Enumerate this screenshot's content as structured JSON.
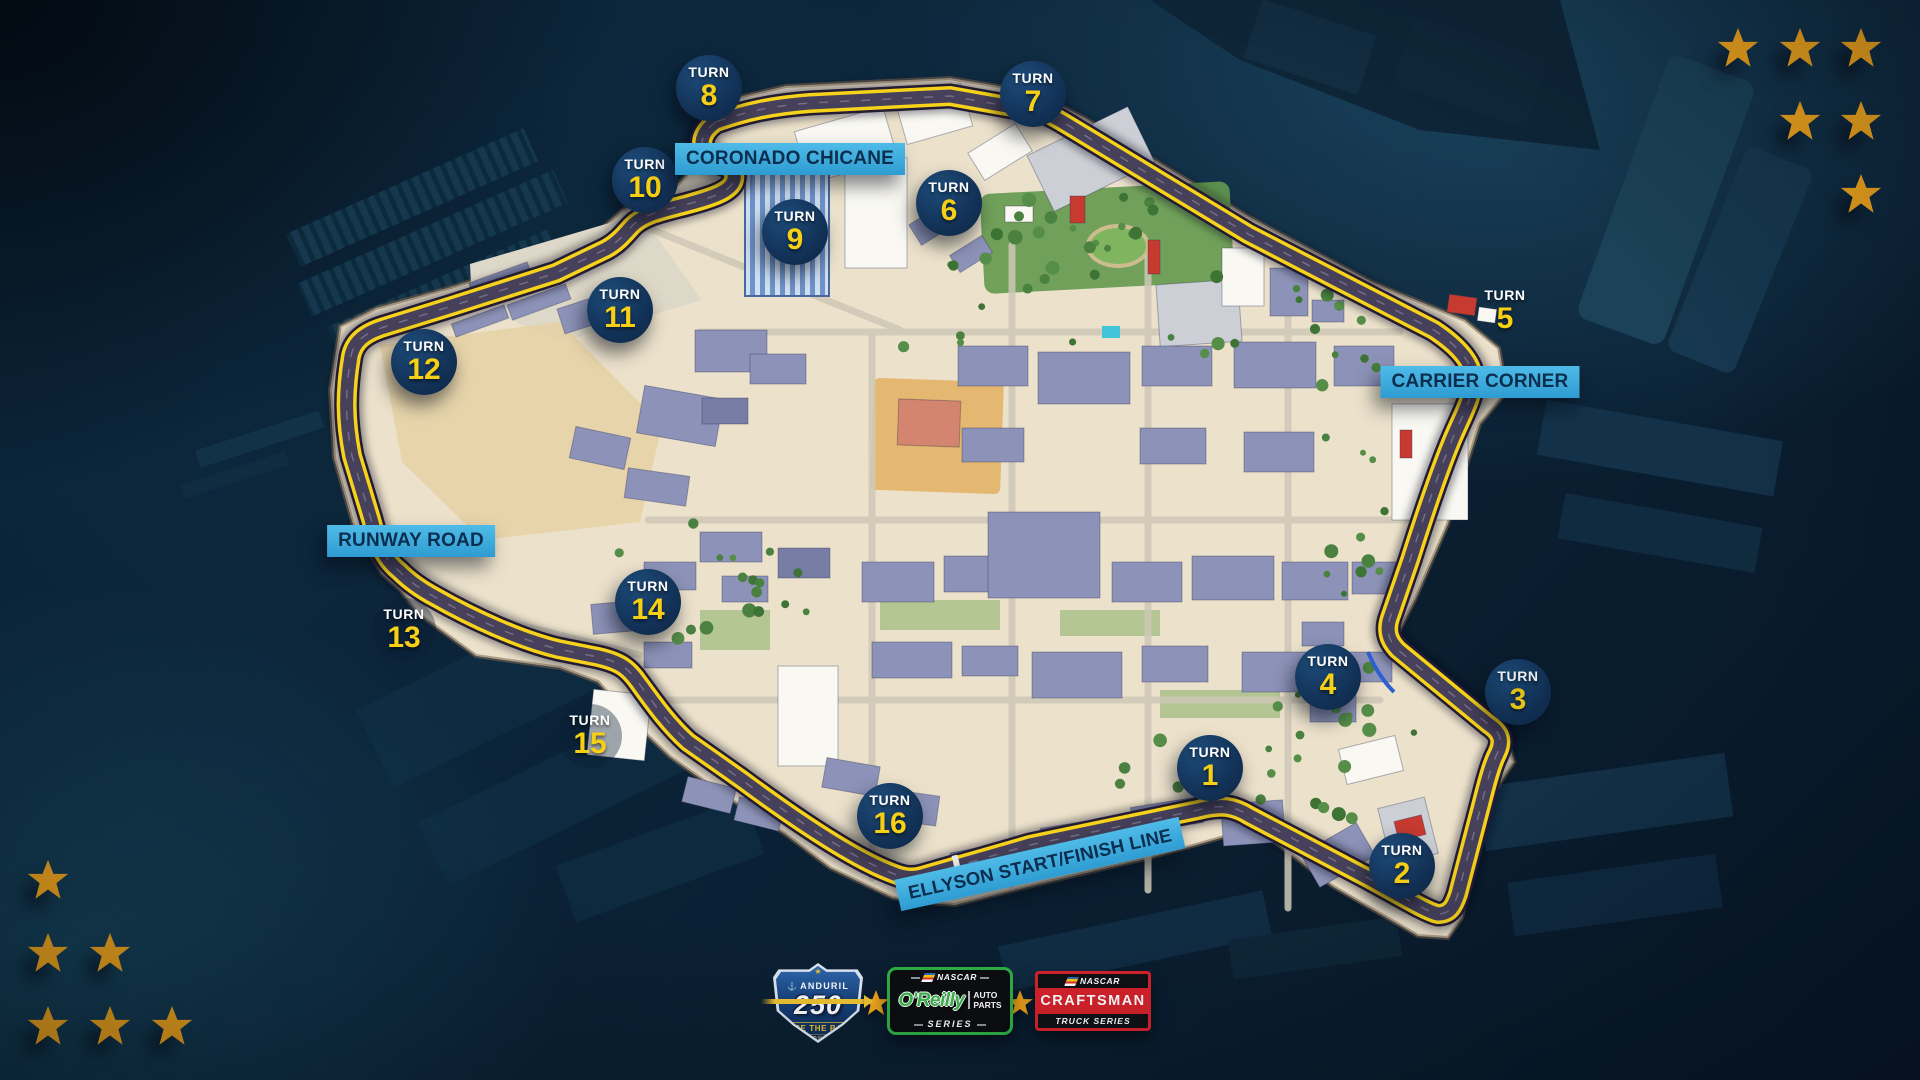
{
  "map": {
    "turn_word": "TURN",
    "turns": [
      {
        "number": "1"
      },
      {
        "number": "2"
      },
      {
        "number": "3"
      },
      {
        "number": "4"
      },
      {
        "number": "5"
      },
      {
        "number": "6"
      },
      {
        "number": "7"
      },
      {
        "number": "8"
      },
      {
        "number": "9"
      },
      {
        "number": "10"
      },
      {
        "number": "11"
      },
      {
        "number": "12"
      },
      {
        "number": "13"
      },
      {
        "number": "14"
      },
      {
        "number": "15"
      },
      {
        "number": "16"
      }
    ],
    "corner_labels": {
      "coronado_chicane": "CORONADO CHICANE",
      "carrier_corner": "CARRIER CORNER",
      "runway_road": "RUNWAY ROAD",
      "start_finish": "ELLYSON START/FINISH LINE"
    }
  },
  "footer": {
    "anduril_badge": {
      "brand": "ANDURIL",
      "race_number": "250",
      "tagline": "RACE THE BASE",
      "location": "CORONADO"
    },
    "oreilly_logo": {
      "sanction": "NASCAR",
      "brand": "O'Reilly",
      "product_top": "AUTO",
      "product_bottom": "PARTS",
      "series": "SERIES"
    },
    "craftsman_logo": {
      "sanction": "NASCAR",
      "brand": "CRAFTSMAN",
      "series": "TRUCK SERIES"
    }
  },
  "colors": {
    "track_yellow": "#f6d21b",
    "track_road": "#46405a",
    "banner_blue": "#3aa7da",
    "turn_circle_navy": "#133355",
    "star_gold": "#f5a81c",
    "water_navy": "#0b2438",
    "island_cream": "#ece2cc"
  }
}
